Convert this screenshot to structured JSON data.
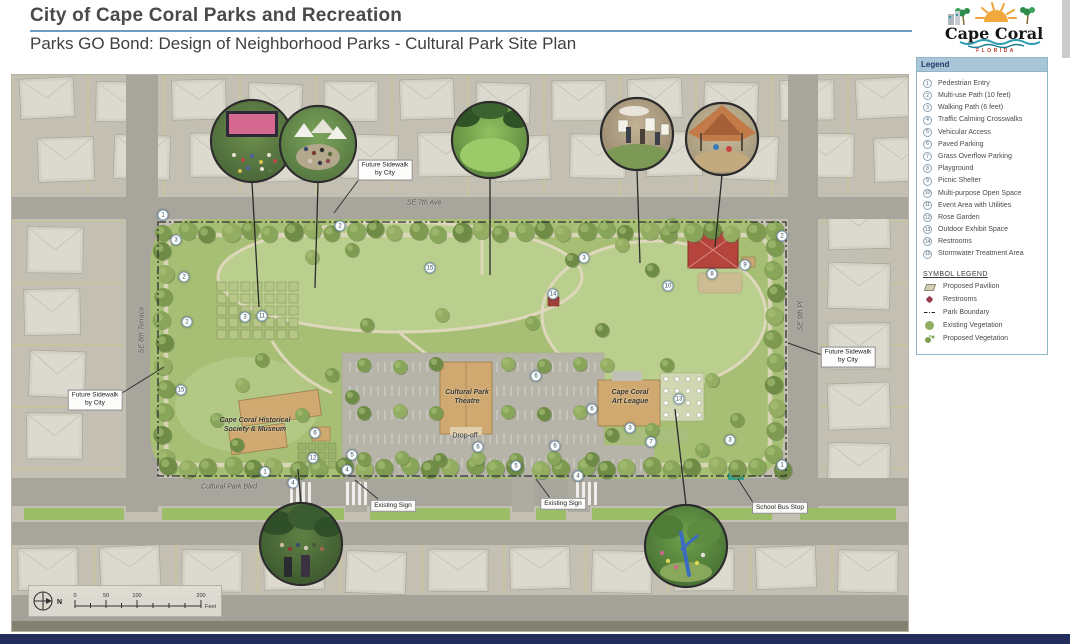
{
  "header": {
    "title": "City of Cape Coral Parks and Recreation",
    "subtitle": "Parks GO Bond: Design of Neighborhood Parks - Cultural Park Site Plan"
  },
  "logo": {
    "name": "Cape Coral",
    "state": "FLORIDA"
  },
  "colors": {
    "accent_rule": "#6d9dbe",
    "legend_border": "#8fb8cc",
    "legend_header_bg": "#a9c6d8",
    "footer_bar": "#232d5c",
    "park_green": "#a6bf74",
    "marker_border": "#7d9cb5",
    "pavilion_red": "#b5443c"
  },
  "legend": {
    "title": "Legend",
    "items": [
      {
        "n": "1",
        "label": "Pedestrian Entry"
      },
      {
        "n": "2",
        "label": "Multi-use Path (10 feet)"
      },
      {
        "n": "3",
        "label": "Walking Path (6 feet)"
      },
      {
        "n": "4",
        "label": "Traffic Calming Crosswalks"
      },
      {
        "n": "5",
        "label": "Vehicular Access"
      },
      {
        "n": "6",
        "label": "Paved Parking"
      },
      {
        "n": "7",
        "label": "Grass Overflow Parking"
      },
      {
        "n": "8",
        "label": "Playground"
      },
      {
        "n": "9",
        "label": "Picnic Shelter"
      },
      {
        "n": "10",
        "label": "Multi-purpose Open Space"
      },
      {
        "n": "11",
        "label": "Event Area with Utilities"
      },
      {
        "n": "12",
        "label": "Rose Garden"
      },
      {
        "n": "13",
        "label": "Outdoor Exhibit Space"
      },
      {
        "n": "14",
        "label": "Restrooms"
      },
      {
        "n": "15",
        "label": "Stormwater Treatment Area"
      }
    ],
    "symbol_title": "SYMBOL LEGEND",
    "symbol_items": [
      {
        "icon": "pavilion-icon",
        "label": "Proposed Pavilion"
      },
      {
        "icon": "restrooms-icon",
        "label": "Restrooms"
      },
      {
        "icon": "boundary-icon",
        "label": "Park Boundary"
      },
      {
        "icon": "existing-veg-icon",
        "label": "Existing Vegetation"
      },
      {
        "icon": "proposed-veg-icon",
        "label": "Proposed Vegetation"
      }
    ]
  },
  "map": {
    "labels": [
      {
        "text": "Future Sidewalk\nby City",
        "x": 373,
        "y": 95,
        "kind": "boxed",
        "name": "note-future-sidewalk-north"
      },
      {
        "text": "Future Sidewalk\nby City",
        "x": 83,
        "y": 325,
        "kind": "boxed",
        "name": "note-future-sidewalk-west"
      },
      {
        "text": "Future Sidewalk\nby City",
        "x": 836,
        "y": 282,
        "kind": "boxed",
        "name": "note-future-sidewalk-east"
      },
      {
        "text": "SE 7th Ave.",
        "x": 413,
        "y": 128,
        "kind": "street",
        "name": "street-se-7th-ave"
      },
      {
        "text": "SE 8th Terrace",
        "x": 130,
        "y": 255,
        "kind": "street vertical",
        "name": "street-se-8th-terrace"
      },
      {
        "text": "SE 9th Pl.",
        "x": 789,
        "y": 240,
        "kind": "street vertical",
        "name": "street-se-9th-pl"
      },
      {
        "text": "Cultural Park Blvd.",
        "x": 218,
        "y": 412,
        "kind": "street",
        "name": "street-cultural-park-blvd"
      },
      {
        "text": "Cape Coral Historical\nSociety & Museum",
        "x": 243,
        "y": 350,
        "kind": "building",
        "name": "label-historical-society-museum"
      },
      {
        "text": "Cultural Park\nTheatre",
        "x": 455,
        "y": 322,
        "kind": "building",
        "name": "label-cultural-park-theatre"
      },
      {
        "text": "Drop-off",
        "x": 453,
        "y": 361,
        "kind": "plain",
        "name": "label-drop-off"
      },
      {
        "text": "Cape Coral\nArt League",
        "x": 618,
        "y": 322,
        "kind": "building",
        "name": "label-art-league"
      },
      {
        "text": "Existing Sign",
        "x": 381,
        "y": 431,
        "kind": "boxed",
        "name": "label-existing-sign-west"
      },
      {
        "text": "Existing Sign",
        "x": 551,
        "y": 429,
        "kind": "boxed",
        "name": "label-existing-sign-east"
      },
      {
        "text": "School Bus Stop",
        "x": 768,
        "y": 433,
        "kind": "boxed",
        "name": "label-school-bus-stop"
      }
    ],
    "markers": [
      {
        "n": "1",
        "x": 151,
        "y": 140
      },
      {
        "n": "3",
        "x": 164,
        "y": 165
      },
      {
        "n": "2",
        "x": 172,
        "y": 202
      },
      {
        "n": "2",
        "x": 175,
        "y": 247
      },
      {
        "n": "15",
        "x": 169,
        "y": 315
      },
      {
        "n": "2",
        "x": 328,
        "y": 151
      },
      {
        "n": "15",
        "x": 418,
        "y": 193
      },
      {
        "n": "3",
        "x": 572,
        "y": 183
      },
      {
        "n": "9",
        "x": 733,
        "y": 190
      },
      {
        "n": "8",
        "x": 700,
        "y": 199
      },
      {
        "n": "10",
        "x": 656,
        "y": 211
      },
      {
        "n": "14",
        "x": 541,
        "y": 219
      },
      {
        "n": "11",
        "x": 250,
        "y": 241
      },
      {
        "n": "3",
        "x": 233,
        "y": 242
      },
      {
        "n": "6",
        "x": 303,
        "y": 358
      },
      {
        "n": "12",
        "x": 301,
        "y": 383
      },
      {
        "n": "5",
        "x": 340,
        "y": 380
      },
      {
        "n": "4",
        "x": 335,
        "y": 395
      },
      {
        "n": "1",
        "x": 253,
        "y": 397
      },
      {
        "n": "6",
        "x": 524,
        "y": 301
      },
      {
        "n": "6",
        "x": 466,
        "y": 372
      },
      {
        "n": "6",
        "x": 543,
        "y": 371
      },
      {
        "n": "6",
        "x": 580,
        "y": 334
      },
      {
        "n": "13",
        "x": 667,
        "y": 324
      },
      {
        "n": "3",
        "x": 618,
        "y": 353
      },
      {
        "n": "7",
        "x": 639,
        "y": 367
      },
      {
        "n": "3",
        "x": 718,
        "y": 365
      },
      {
        "n": "4",
        "x": 281,
        "y": 408
      },
      {
        "n": "4",
        "x": 566,
        "y": 401
      },
      {
        "n": "1",
        "x": 770,
        "y": 390
      },
      {
        "n": "2",
        "x": 770,
        "y": 161
      },
      {
        "n": "5",
        "x": 504,
        "y": 391
      }
    ],
    "photos": [
      {
        "name": "photo-outdoor-movie-night",
        "x": 240,
        "y": 66,
        "r": 41
      },
      {
        "name": "photo-festival-market",
        "x": 306,
        "y": 69,
        "r": 38
      },
      {
        "name": "photo-open-lawn",
        "x": 478,
        "y": 65,
        "r": 38
      },
      {
        "name": "photo-outdoor-art-class",
        "x": 625,
        "y": 59,
        "r": 36
      },
      {
        "name": "photo-shaded-playground",
        "x": 710,
        "y": 64,
        "r": 36
      },
      {
        "name": "photo-community-event",
        "x": 289,
        "y": 469,
        "r": 41
      },
      {
        "name": "photo-botanical-garden",
        "x": 674,
        "y": 471,
        "r": 41
      }
    ],
    "scalebar": {
      "ticks": [
        "0",
        "50",
        "100",
        "200"
      ],
      "unit": "Feet",
      "north_label": "N"
    }
  }
}
